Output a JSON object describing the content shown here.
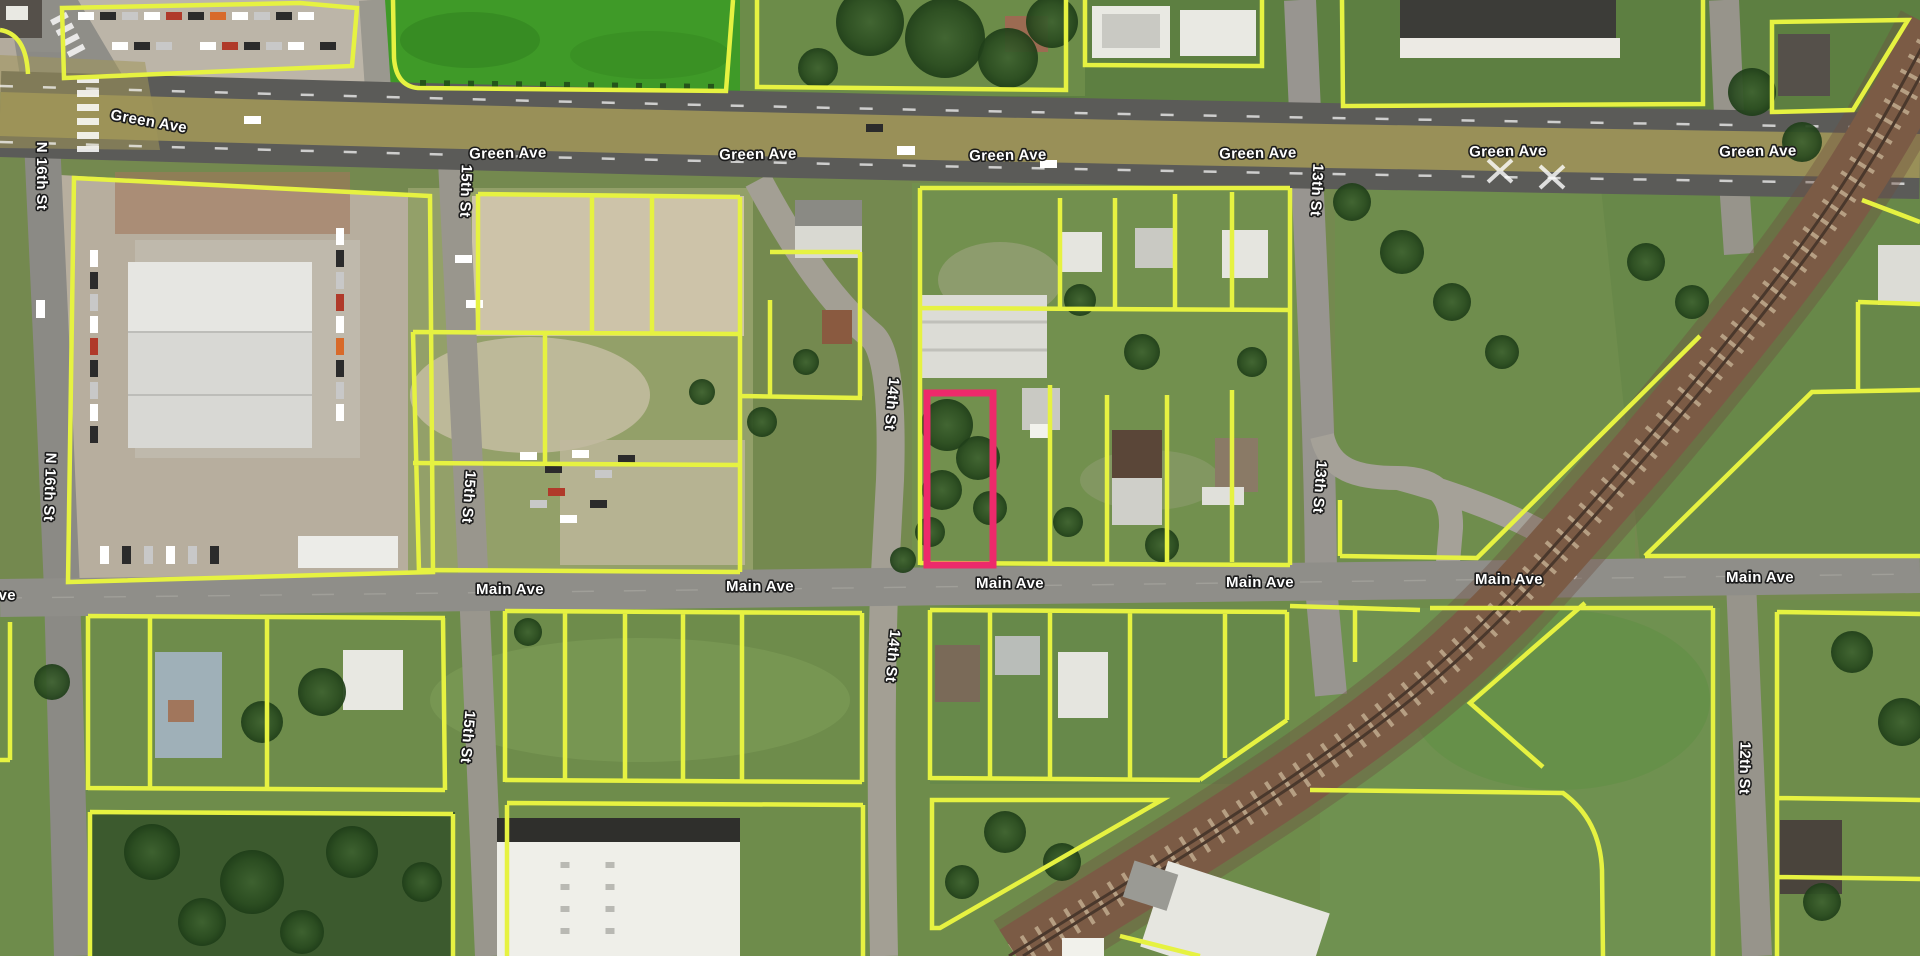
{
  "map": {
    "streets": {
      "green_ave": "Green Ave",
      "main_ave": "Main Ave",
      "n_16th_st": "N 16th St",
      "st_15th": "15th St",
      "st_14th": "14th St",
      "st_13th": "13th St",
      "st_12th": "12th St"
    },
    "colors": {
      "parcel_outline": "#e6f241",
      "selected_parcel": "#ed2a6b",
      "label_fill": "#ffffff",
      "label_outline": "#1c1c1c",
      "green_ave_median": "#a09659"
    },
    "selected_parcel": {
      "highlighted": true
    }
  }
}
